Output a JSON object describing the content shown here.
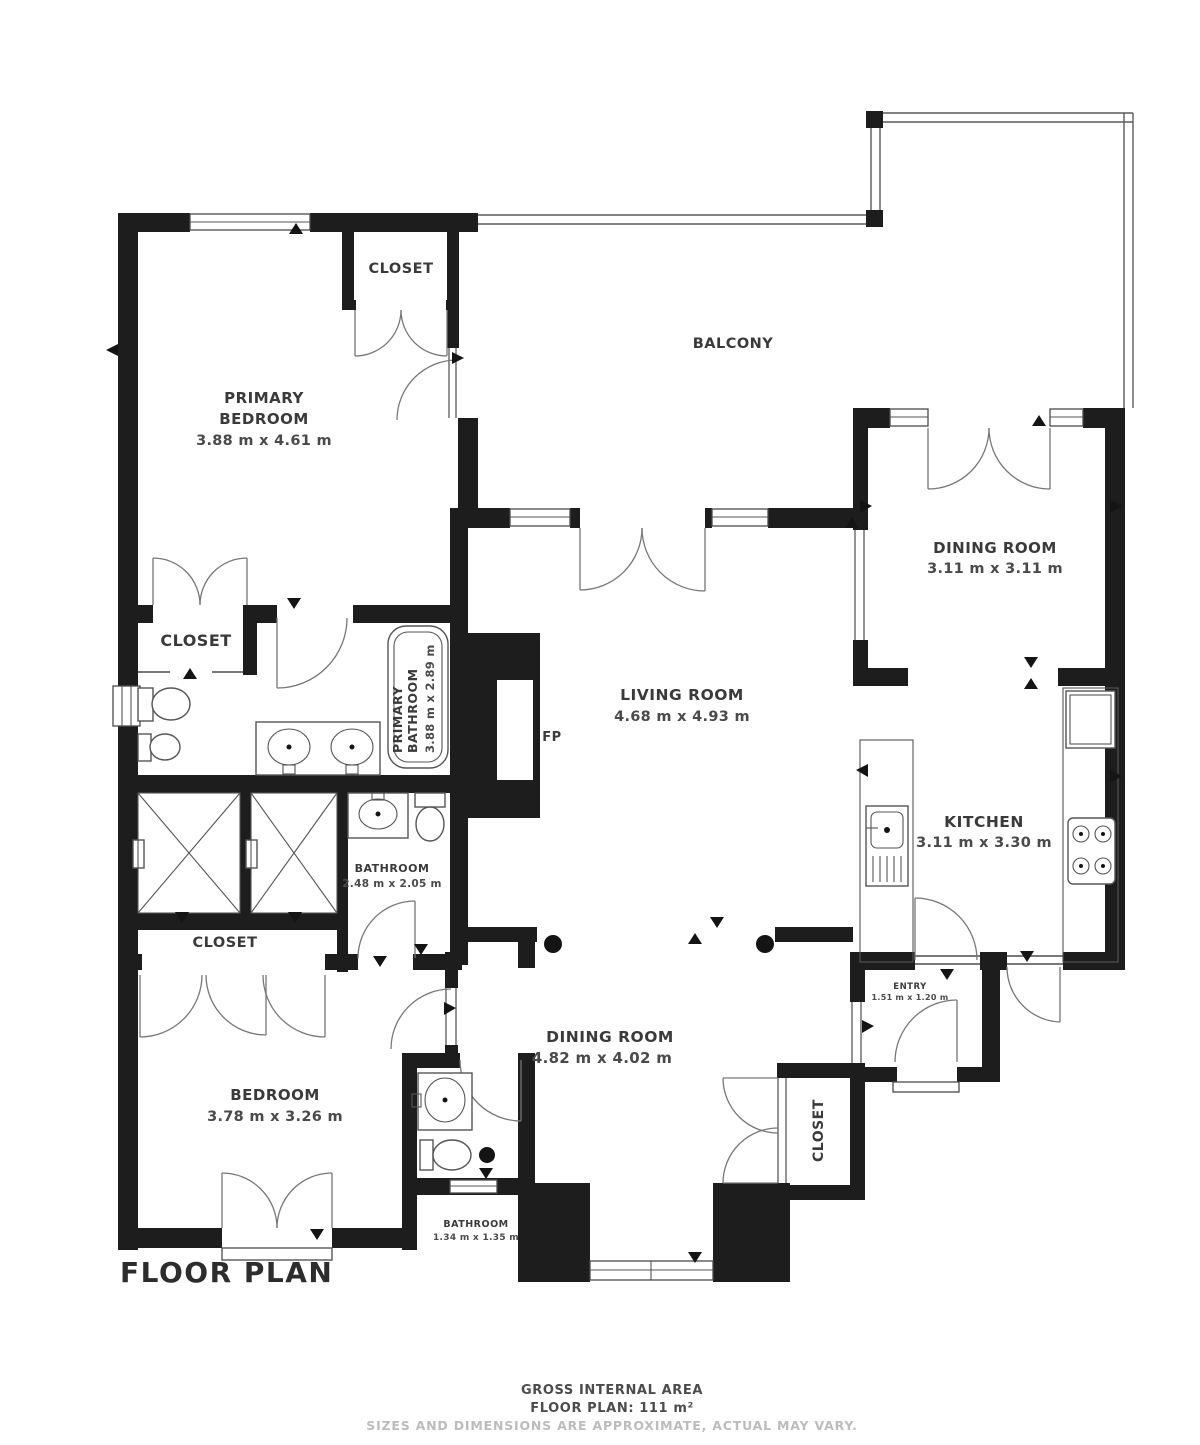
{
  "title": "FLOOR PLAN",
  "footer": {
    "line1": "GROSS INTERNAL AREA",
    "line2": "FLOOR PLAN: 111 m²",
    "line3": "SIZES AND DIMENSIONS ARE APPROXIMATE, ACTUAL MAY VARY."
  },
  "rooms": {
    "primary_bedroom": {
      "name_line1": "PRIMARY",
      "name_line2": "BEDROOM",
      "dims": "3.88 m x 4.61 m"
    },
    "closet_top": {
      "name": "CLOSET"
    },
    "balcony": {
      "name": "BALCONY"
    },
    "dining_room_upper": {
      "name": "DINING ROOM",
      "dims": "3.11 m x 3.11 m"
    },
    "closet_mid": {
      "name": "CLOSET"
    },
    "primary_bathroom": {
      "name_line1": "PRIMARY",
      "name_line2": "BATHROOM",
      "dims": "3.88 m x 2.89 m"
    },
    "living_room": {
      "name": "LIVING ROOM",
      "dims": "4.68 m x 4.93 m"
    },
    "fireplace": {
      "label": "FP"
    },
    "kitchen": {
      "name": "KITCHEN",
      "dims": "3.11 m x 3.30 m"
    },
    "bathroom_mid": {
      "name": "BATHROOM",
      "dims": "2.48 m x 2.05 m"
    },
    "closet_lower": {
      "name": "CLOSET"
    },
    "entry": {
      "name": "ENTRY",
      "dims": "1.51 m x 1.20 m"
    },
    "dining_room_lower": {
      "name": "DINING ROOM",
      "dims": "4.82 m x 4.02 m"
    },
    "bedroom": {
      "name": "BEDROOM",
      "dims": "3.78 m x 3.26 m"
    },
    "closet_bottom_right": {
      "name": "CLOSET"
    },
    "bathroom_small": {
      "name": "BATHROOM",
      "dims": "1.34 m x 1.35 m"
    }
  },
  "colors": {
    "wall": "#1d1d1d",
    "line": "#4d4d4d",
    "text": "#3a3a3a",
    "muted": "#bcbcbc"
  }
}
